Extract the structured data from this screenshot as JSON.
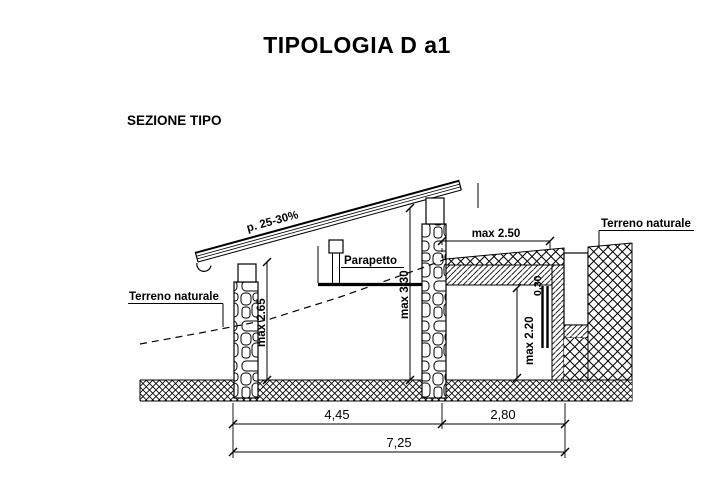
{
  "title": "TIPOLOGIA D a1",
  "section": {
    "label": "SEZIONE TIPO"
  },
  "annotations": {
    "roof_slope": "p. 25-30%",
    "parapet": "Parapetto",
    "terrain_left": "Terreno naturale",
    "terrain_right": "Terreno naturale"
  },
  "dimensions": {
    "terrace_width": "max 2.50",
    "front_height": "max 2.65",
    "ridge_height": "max 3.30",
    "room_height": "max 2.20",
    "slab_thickness": "0,30",
    "span_left": "4,45",
    "span_right": "2,80",
    "span_total": "7,25"
  },
  "colors": {
    "line": "#000000",
    "background": "#ffffff"
  }
}
